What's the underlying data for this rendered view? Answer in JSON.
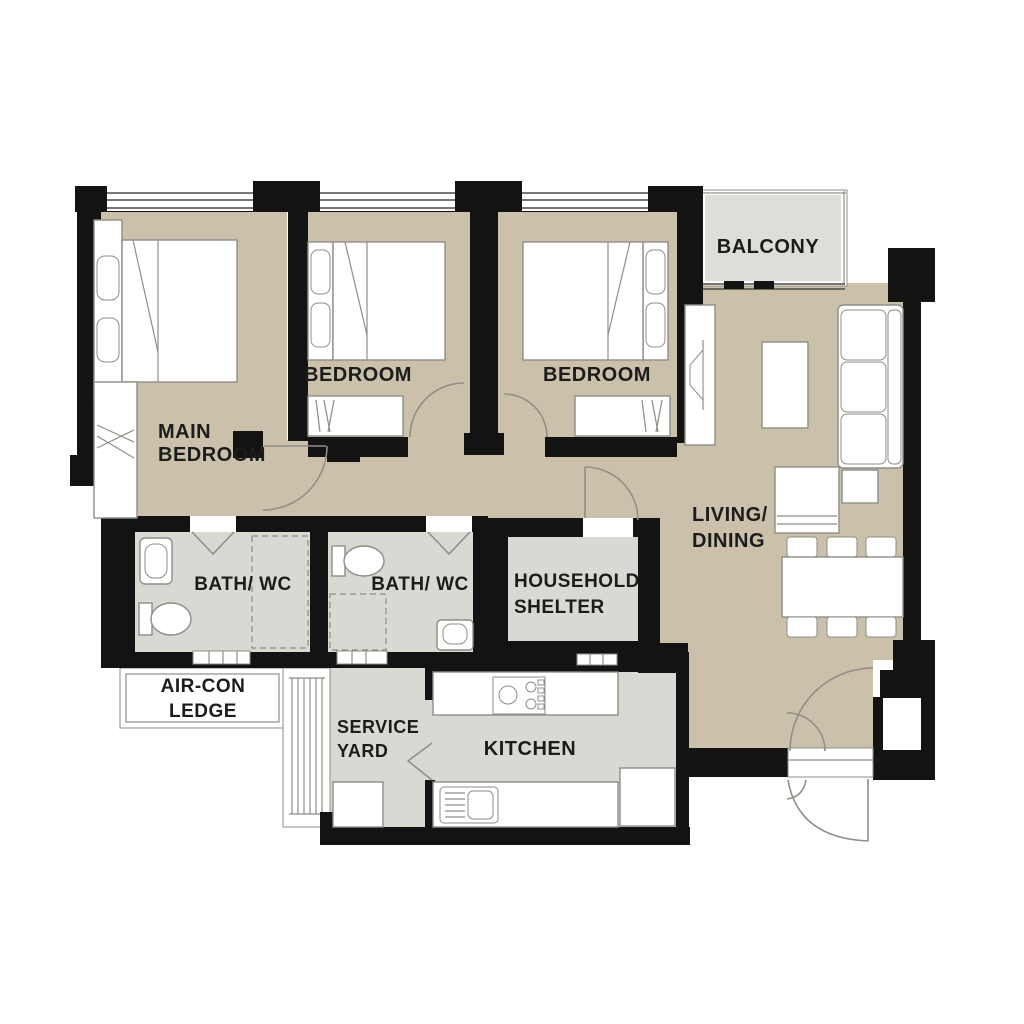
{
  "plan": {
    "type": "apartment-floor-plan",
    "rooms": {
      "main_bedroom": {
        "label_lines": [
          "MAIN",
          "BEDROOM"
        ]
      },
      "bedroom_2": {
        "label_lines": [
          "BEDROOM"
        ]
      },
      "bedroom_3": {
        "label_lines": [
          "BEDROOM"
        ]
      },
      "balcony": {
        "label_lines": [
          "BALCONY"
        ]
      },
      "living_dining": {
        "label_lines": [
          "LIVING/",
          "DINING"
        ]
      },
      "bath_wc_1": {
        "label_lines": [
          "BATH/ WC"
        ]
      },
      "bath_wc_2": {
        "label_lines": [
          "BATH/ WC"
        ]
      },
      "household_shelter": {
        "label_lines": [
          "HOUSEHOLD",
          "SHELTER"
        ]
      },
      "air_con_ledge": {
        "label_lines": [
          "AIR-CON",
          "LEDGE"
        ]
      },
      "service_yard": {
        "label_lines": [
          "SERVICE",
          "YARD"
        ]
      },
      "kitchen": {
        "label_lines": [
          "KITCHEN"
        ]
      }
    },
    "furniture_icons": [
      "double-bed",
      "wardrobe",
      "single-bed",
      "single-bed",
      "tv-console",
      "coffee-table",
      "sofa",
      "armchair",
      "side-table",
      "dining-table",
      "dining-chair",
      "toilet",
      "wash-basin",
      "shower-area",
      "cooker-hob",
      "kitchen-sink",
      "kitchen-counter",
      "refrigerator",
      "washing-machine",
      "air-con-louvre",
      "door-swing",
      "window-band"
    ]
  },
  "colors": {
    "wall": "#131313",
    "floor_warm": "#cbc1ab",
    "floor_cool": "#d9d8d2",
    "floor_balcony": "#deded8",
    "line": "#8e8e87",
    "label": "#1c1c1c",
    "background": "#ffffff"
  }
}
